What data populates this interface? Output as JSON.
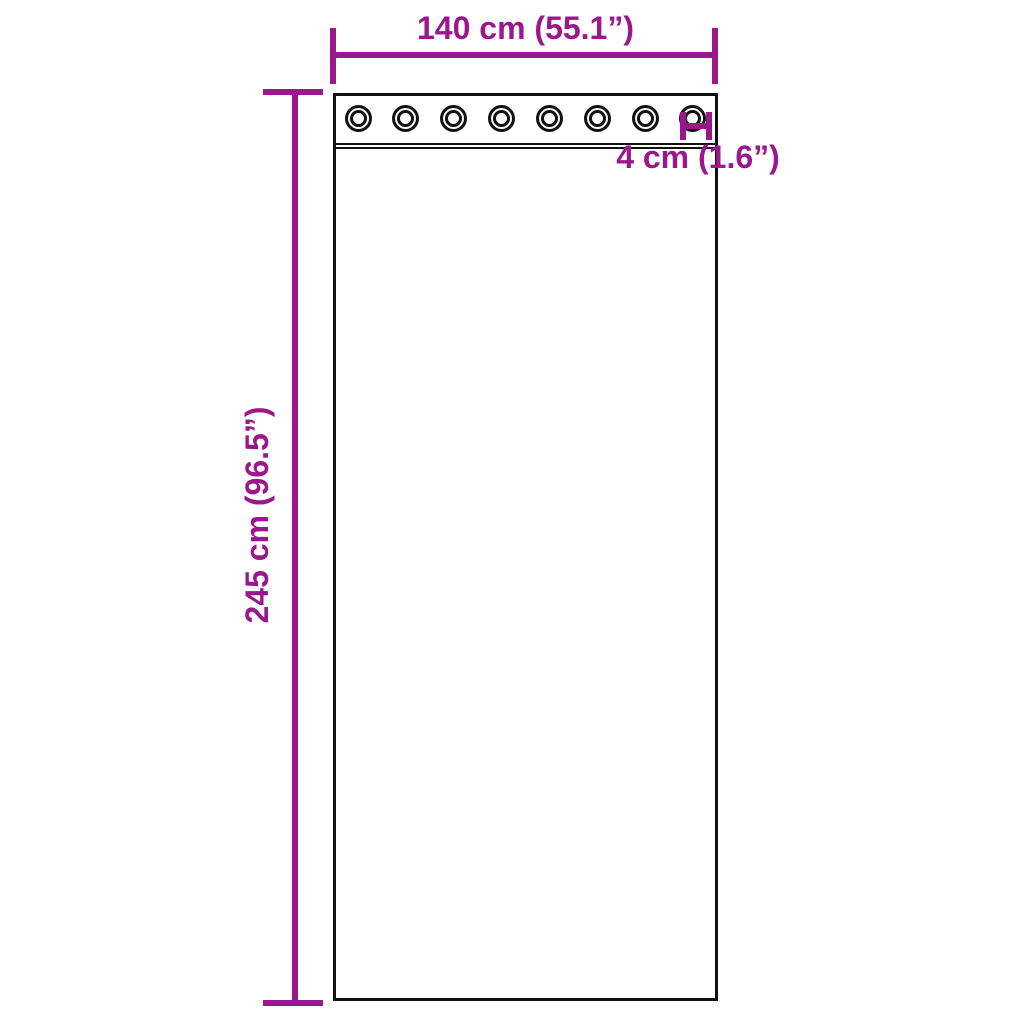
{
  "colors": {
    "accent": "#9B178C",
    "line": "#111111",
    "background": "#FFFFFF"
  },
  "diagram": {
    "type": "product-dimension-diagram",
    "subject": "curtain panel with grommets",
    "grommet_count": 8,
    "dimensions": {
      "width": {
        "label": "140 cm (55.1”)"
      },
      "height": {
        "label": "245 cm (96.5”)"
      },
      "grommet": {
        "label": "4 cm (1.6”)"
      }
    }
  }
}
